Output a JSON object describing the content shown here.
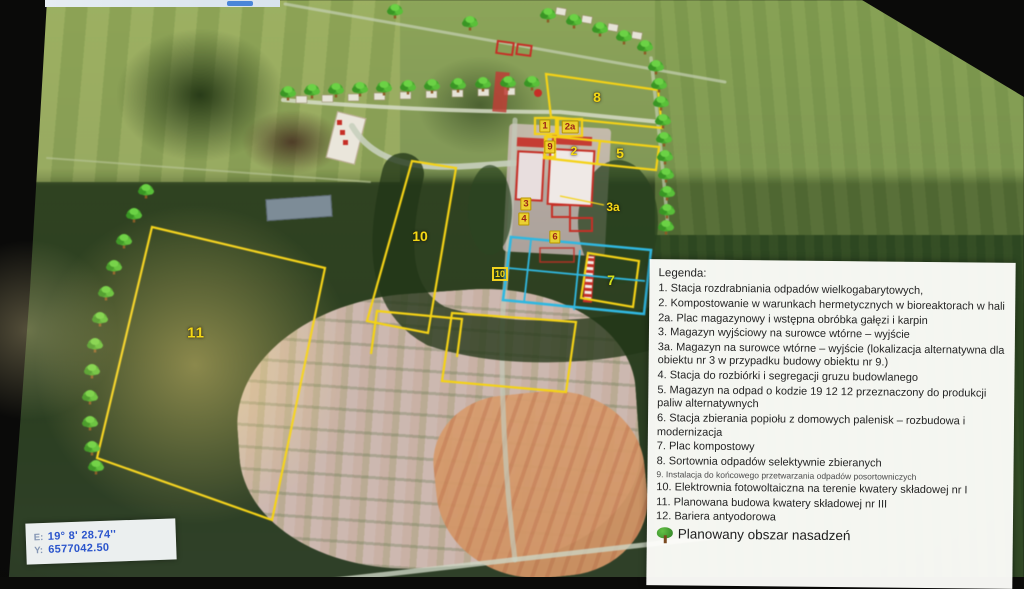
{
  "colors": {
    "outline_yellow": "#f2d21f",
    "outline_cyan": "#35b6dd",
    "outline_red": "#c03028",
    "legend_background": "#fdfdfa",
    "coordinate_text_blue": "#2b55cc",
    "tree_icon_green": "#4aa832"
  },
  "map": {
    "labels": [
      {
        "text": "8"
      },
      {
        "text": "1"
      },
      {
        "text": "2a"
      },
      {
        "text": "9"
      },
      {
        "text": "2"
      },
      {
        "text": "5"
      },
      {
        "text": "3a"
      },
      {
        "text": "3"
      },
      {
        "text": "4"
      },
      {
        "text": "6"
      },
      {
        "text": "7"
      },
      {
        "text": "10"
      },
      {
        "text": "10"
      },
      {
        "text": "11"
      }
    ],
    "trees": [
      [
        288,
        92
      ],
      [
        312,
        90
      ],
      [
        336,
        89
      ],
      [
        360,
        88
      ],
      [
        384,
        87
      ],
      [
        408,
        86
      ],
      [
        432,
        85
      ],
      [
        458,
        84
      ],
      [
        483,
        83
      ],
      [
        508,
        82
      ],
      [
        532,
        82
      ],
      [
        395,
        10
      ],
      [
        470,
        22
      ],
      [
        548,
        14
      ],
      [
        574,
        20
      ],
      [
        600,
        28
      ],
      [
        624,
        36
      ],
      [
        645,
        46
      ],
      [
        656,
        66
      ],
      [
        659,
        84
      ],
      [
        661,
        102
      ],
      [
        663,
        120
      ],
      [
        664,
        138
      ],
      [
        665,
        156
      ],
      [
        666,
        174
      ],
      [
        667,
        192
      ],
      [
        667,
        210
      ],
      [
        666,
        226
      ],
      [
        146,
        190
      ],
      [
        134,
        214
      ],
      [
        124,
        240
      ],
      [
        114,
        266
      ],
      [
        106,
        292
      ],
      [
        100,
        318
      ],
      [
        95,
        344
      ],
      [
        92,
        370
      ],
      [
        90,
        396
      ],
      [
        90,
        422
      ],
      [
        92,
        447
      ],
      [
        96,
        466
      ]
    ]
  },
  "legend": {
    "title": "Legenda:",
    "items": [
      {
        "text": "1. Stacja rozdrabniania odpadów wielkogabarytowych,"
      },
      {
        "text": "2. Kompostowanie w warunkach hermetycznych w bioreaktorach w hali"
      },
      {
        "text": "2a. Plac magazynowy i wstępna obróbka gałęzi i karpin"
      },
      {
        "text": "3. Magazyn wyjściowy na surowce wtórne – wyjście"
      },
      {
        "text": "3a. Magazyn na surowce wtórne – wyjście  (lokalizacja alternatywna dla obiektu nr 3  w przypadku budowy obiektu nr 9.)"
      },
      {
        "text": "4. Stacja do rozbiórki i segregacji gruzu budowlanego"
      },
      {
        "text": "5. Magazyn na odpad o kodzie 19 12 12 przeznaczony do produkcji paliw alternatywnych"
      },
      {
        "text": "6. Stacja zbierania popiołu z domowych palenisk – rozbudowa i modernizacja"
      },
      {
        "text": "7. Plac kompostowy"
      },
      {
        "text": "8. Sortownia odpadów selektywnie zbieranych"
      },
      {
        "text": "9. Instalacja do końcowego przetwarzania odpadów posortowniczych"
      },
      {
        "text": "10. Elektrownia fotowoltaiczna na terenie kwatery składowej nr I"
      },
      {
        "text": "11. Planowana budowa kwatery składowej nr III"
      },
      {
        "text": "12. Bariera antyodorowa"
      }
    ],
    "footer": {
      "icon": "tree-icon",
      "text": "Planowany obszar nasadzeń"
    }
  },
  "coordinates": {
    "rows": [
      {
        "label": "E:",
        "value": "19° 8' 28.74''"
      },
      {
        "label": "Y:",
        "value": "6577042.50"
      }
    ]
  }
}
